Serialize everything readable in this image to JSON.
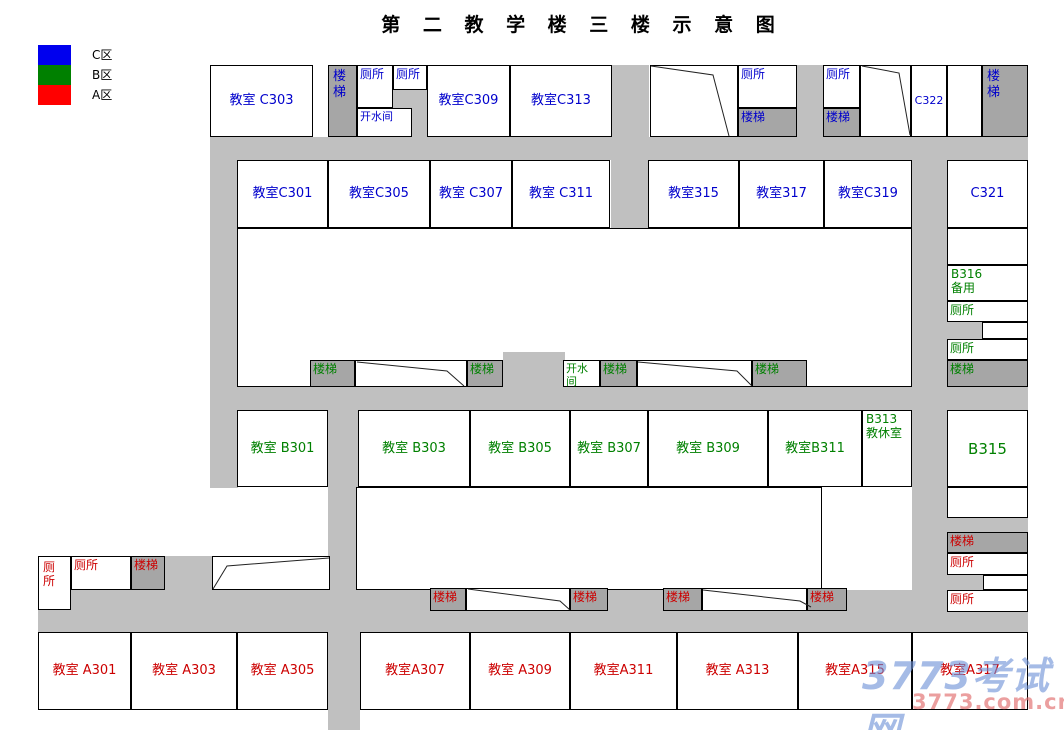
{
  "title": "第 二 教 学 楼 三 楼 示 意 图",
  "legend": [
    {
      "name": "legend-zone-c",
      "label": "C区",
      "color": "#0000ee"
    },
    {
      "name": "legend-zone-b",
      "label": "B区",
      "color": "#008000"
    },
    {
      "name": "legend-zone-a",
      "label": "A区",
      "color": "#ff0000"
    }
  ],
  "palette": {
    "corridor": "#c0c0c0",
    "stair_fill": "#a6a6a6",
    "room_fill": "#ffffff",
    "border": "#000000",
    "zone_c_text": "#0000cc",
    "zone_b_text": "#008000",
    "zone_a_text": "#cc0000",
    "title_text": "#000000"
  },
  "watermark": {
    "line1": "3773考试网",
    "line2": "3773.com.cn",
    "color1": "rgba(110,145,215,0.62)",
    "color2": "rgba(225,110,110,0.66)"
  },
  "corridors": [
    {
      "x": 210,
      "y": 137,
      "w": 818,
      "h": 23
    },
    {
      "x": 210,
      "y": 387,
      "w": 818,
      "h": 23
    },
    {
      "x": 38,
      "y": 590,
      "w": 990,
      "h": 42
    },
    {
      "x": 210,
      "y": 137,
      "w": 28,
      "h": 351
    },
    {
      "x": 611,
      "y": 65,
      "w": 38,
      "h": 163
    },
    {
      "x": 912,
      "y": 137,
      "w": 35,
      "h": 495
    },
    {
      "x": 328,
      "y": 408,
      "w": 30,
      "h": 224
    },
    {
      "x": 328,
      "y": 632,
      "w": 32,
      "h": 98
    },
    {
      "x": 797,
      "y": 65,
      "w": 26,
      "h": 72
    },
    {
      "x": 393,
      "y": 90,
      "w": 19,
      "h": 18
    },
    {
      "x": 412,
      "y": 90,
      "w": 15,
      "h": 47
    },
    {
      "x": 947,
      "y": 322,
      "w": 35,
      "h": 17
    },
    {
      "x": 947,
      "y": 518,
      "w": 81,
      "h": 14
    },
    {
      "x": 947,
      "y": 575,
      "w": 36,
      "h": 15
    },
    {
      "x": 165,
      "y": 556,
      "w": 47,
      "h": 34
    }
  ],
  "rooms": [
    {
      "name": "room-c303",
      "label": "教室 C303",
      "zone": "C",
      "x": 210,
      "y": 65,
      "w": 103,
      "h": 72,
      "kind": "room",
      "style": "c"
    },
    {
      "name": "stair-top-left",
      "label": "楼\n梯",
      "zone": "C",
      "x": 328,
      "y": 65,
      "w": 29,
      "h": 72,
      "kind": "stair",
      "style": "spread"
    },
    {
      "name": "toilet-top-1",
      "label": "厕所",
      "zone": "C",
      "x": 357,
      "y": 65,
      "w": 36,
      "h": 43,
      "kind": "room",
      "style": "tl",
      "fs": 12
    },
    {
      "name": "toilet-top-2",
      "label": "厕所",
      "zone": "C",
      "x": 393,
      "y": 65,
      "w": 34,
      "h": 25,
      "kind": "room",
      "style": "tl",
      "fs": 12
    },
    {
      "name": "boiler-room-top",
      "label": "开水间",
      "zone": "C",
      "x": 357,
      "y": 108,
      "w": 55,
      "h": 29,
      "kind": "room",
      "style": "tl",
      "fs": 11
    },
    {
      "name": "room-c309",
      "label": "教室C309",
      "zone": "C",
      "x": 427,
      "y": 65,
      "w": 83,
      "h": 72,
      "kind": "room",
      "style": "c"
    },
    {
      "name": "room-c313",
      "label": "教室C313",
      "zone": "C",
      "x": 510,
      "y": 65,
      "w": 102,
      "h": 72,
      "kind": "room",
      "style": "c"
    },
    {
      "name": "stairwell-top-1",
      "label": "",
      "zone": "",
      "x": 650,
      "y": 65,
      "w": 88,
      "h": 72,
      "kind": "room",
      "style": "c"
    },
    {
      "name": "toilet-top-3",
      "label": "厕所",
      "zone": "C",
      "x": 738,
      "y": 65,
      "w": 59,
      "h": 43,
      "kind": "room",
      "style": "tl",
      "fs": 12
    },
    {
      "name": "stair-top-1",
      "label": "楼梯",
      "zone": "C",
      "x": 738,
      "y": 108,
      "w": 59,
      "h": 29,
      "kind": "stair",
      "style": "tl",
      "fs": 12
    },
    {
      "name": "toilet-top-4",
      "label": "厕所",
      "zone": "C",
      "x": 823,
      "y": 65,
      "w": 37,
      "h": 43,
      "kind": "room",
      "style": "tl",
      "fs": 12
    },
    {
      "name": "stair-top-2",
      "label": "楼梯",
      "zone": "C",
      "x": 823,
      "y": 108,
      "w": 37,
      "h": 29,
      "kind": "stair",
      "style": "tl",
      "fs": 12
    },
    {
      "name": "stairwell-top-2",
      "label": "",
      "zone": "",
      "x": 860,
      "y": 65,
      "w": 51,
      "h": 72,
      "kind": "room",
      "style": "c"
    },
    {
      "name": "room-c322",
      "label": "C322",
      "zone": "C",
      "x": 911,
      "y": 65,
      "w": 36,
      "h": 72,
      "kind": "room",
      "style": "c",
      "fs": 11
    },
    {
      "name": "room-top-right-blank",
      "label": "",
      "zone": "",
      "x": 947,
      "y": 65,
      "w": 35,
      "h": 72,
      "kind": "room",
      "style": "c"
    },
    {
      "name": "stair-top-right",
      "label": "楼\n梯",
      "zone": "C",
      "x": 982,
      "y": 65,
      "w": 46,
      "h": 72,
      "kind": "stair",
      "style": "spread"
    },
    {
      "name": "room-c301",
      "label": "教室C301",
      "zone": "C",
      "x": 237,
      "y": 160,
      "w": 91,
      "h": 68,
      "kind": "room",
      "style": "c"
    },
    {
      "name": "room-c305",
      "label": "教室C305",
      "zone": "C",
      "x": 328,
      "y": 160,
      "w": 102,
      "h": 68,
      "kind": "room",
      "style": "c"
    },
    {
      "name": "room-c307",
      "label": "教室 C307",
      "zone": "C",
      "x": 430,
      "y": 160,
      "w": 82,
      "h": 68,
      "kind": "room",
      "style": "c"
    },
    {
      "name": "room-c311",
      "label": "教室 C311",
      "zone": "C",
      "x": 512,
      "y": 160,
      "w": 98,
      "h": 68,
      "kind": "room",
      "style": "c"
    },
    {
      "name": "room-315",
      "label": "教室315",
      "zone": "C",
      "x": 648,
      "y": 160,
      "w": 91,
      "h": 68,
      "kind": "room",
      "style": "c"
    },
    {
      "name": "room-317",
      "label": "教室317",
      "zone": "C",
      "x": 739,
      "y": 160,
      "w": 85,
      "h": 68,
      "kind": "room",
      "style": "c"
    },
    {
      "name": "room-c319",
      "label": "教室C319",
      "zone": "C",
      "x": 824,
      "y": 160,
      "w": 88,
      "h": 68,
      "kind": "room",
      "style": "c"
    },
    {
      "name": "room-c321",
      "label": "C321",
      "zone": "C",
      "x": 947,
      "y": 160,
      "w": 81,
      "h": 68,
      "kind": "room",
      "style": "c"
    },
    {
      "name": "courtyard-upper",
      "label": "",
      "zone": "",
      "x": 237,
      "y": 228,
      "w": 675,
      "h": 159,
      "kind": "room",
      "style": "c"
    },
    {
      "name": "corridor-notch-mid",
      "label": "",
      "zone": "",
      "x": 503,
      "y": 352,
      "w": 62,
      "h": 35,
      "kind": "corridor",
      "style": "c"
    },
    {
      "name": "stair-mid-1",
      "label": "楼梯",
      "zone": "B",
      "x": 310,
      "y": 360,
      "w": 45,
      "h": 27,
      "kind": "stair",
      "style": "tl",
      "fs": 12
    },
    {
      "name": "stairwell-mid-1",
      "label": "",
      "zone": "",
      "x": 355,
      "y": 360,
      "w": 112,
      "h": 27,
      "kind": "room",
      "style": "c"
    },
    {
      "name": "stair-mid-2",
      "label": "楼梯",
      "zone": "B",
      "x": 467,
      "y": 360,
      "w": 36,
      "h": 27,
      "kind": "stair",
      "style": "tl",
      "fs": 12
    },
    {
      "name": "boiler-room-mid",
      "label": "开水间",
      "zone": "B",
      "x": 563,
      "y": 360,
      "w": 37,
      "h": 27,
      "kind": "room",
      "style": "tl",
      "fs": 11
    },
    {
      "name": "stair-mid-3",
      "label": "楼梯",
      "zone": "B",
      "x": 600,
      "y": 360,
      "w": 37,
      "h": 27,
      "kind": "stair",
      "style": "tl",
      "fs": 12
    },
    {
      "name": "stairwell-mid-2",
      "label": "",
      "zone": "",
      "x": 637,
      "y": 360,
      "w": 115,
      "h": 27,
      "kind": "room",
      "style": "c"
    },
    {
      "name": "stair-mid-4",
      "label": "楼梯",
      "zone": "B",
      "x": 752,
      "y": 360,
      "w": 55,
      "h": 27,
      "kind": "stair",
      "style": "tl",
      "fs": 12
    },
    {
      "name": "room-b301",
      "label": "教室 B301",
      "zone": "B",
      "x": 237,
      "y": 410,
      "w": 91,
      "h": 77,
      "kind": "room",
      "style": "c"
    },
    {
      "name": "room-b303",
      "label": "教室 B303",
      "zone": "B",
      "x": 358,
      "y": 410,
      "w": 112,
      "h": 77,
      "kind": "room",
      "style": "c"
    },
    {
      "name": "room-b305",
      "label": "教室 B305",
      "zone": "B",
      "x": 470,
      "y": 410,
      "w": 100,
      "h": 77,
      "kind": "room",
      "style": "c"
    },
    {
      "name": "room-b307",
      "label": "教室 B307",
      "zone": "B",
      "x": 570,
      "y": 410,
      "w": 78,
      "h": 77,
      "kind": "room",
      "style": "c"
    },
    {
      "name": "room-b309",
      "label": "教室 B309",
      "zone": "B",
      "x": 648,
      "y": 410,
      "w": 120,
      "h": 77,
      "kind": "room",
      "style": "c"
    },
    {
      "name": "room-b311",
      "label": "教室B311",
      "zone": "B",
      "x": 768,
      "y": 410,
      "w": 94,
      "h": 77,
      "kind": "room",
      "style": "c"
    },
    {
      "name": "room-b313",
      "label": "B313\n教休室",
      "zone": "B",
      "x": 862,
      "y": 410,
      "w": 50,
      "h": 77,
      "kind": "room",
      "style": "two",
      "fs": 12
    },
    {
      "name": "room-b315",
      "label": "B315",
      "zone": "B",
      "x": 947,
      "y": 410,
      "w": 81,
      "h": 77,
      "kind": "room",
      "style": "c",
      "fs": 15
    },
    {
      "name": "room-right-blank-1",
      "label": "",
      "zone": "",
      "x": 947,
      "y": 228,
      "w": 81,
      "h": 37,
      "kind": "room",
      "style": "c"
    },
    {
      "name": "room-b316",
      "label": "B316\n备用",
      "zone": "B",
      "x": 947,
      "y": 265,
      "w": 81,
      "h": 36,
      "kind": "room",
      "style": "two",
      "fs": 12
    },
    {
      "name": "toilet-right-1",
      "label": "厕所",
      "zone": "B",
      "x": 947,
      "y": 301,
      "w": 81,
      "h": 21,
      "kind": "room",
      "style": "tl",
      "fs": 12
    },
    {
      "name": "room-right-offset-1",
      "label": "",
      "zone": "",
      "x": 982,
      "y": 322,
      "w": 46,
      "h": 17,
      "kind": "room",
      "style": "c"
    },
    {
      "name": "toilet-right-2",
      "label": "厕所",
      "zone": "B",
      "x": 947,
      "y": 339,
      "w": 81,
      "h": 21,
      "kind": "room",
      "style": "tl",
      "fs": 12
    },
    {
      "name": "stair-right-1",
      "label": "楼梯",
      "zone": "B",
      "x": 947,
      "y": 360,
      "w": 81,
      "h": 27,
      "kind": "stair",
      "style": "tl",
      "fs": 12
    },
    {
      "name": "room-right-blank-2",
      "label": "",
      "zone": "",
      "x": 947,
      "y": 487,
      "w": 81,
      "h": 31,
      "kind": "room",
      "style": "c"
    },
    {
      "name": "stair-right-2",
      "label": "楼梯",
      "zone": "A",
      "x": 947,
      "y": 532,
      "w": 81,
      "h": 21,
      "kind": "stair",
      "style": "tl",
      "fs": 12
    },
    {
      "name": "toilet-right-3",
      "label": "厕所",
      "zone": "A",
      "x": 947,
      "y": 553,
      "w": 81,
      "h": 22,
      "kind": "room",
      "style": "tl",
      "fs": 12
    },
    {
      "name": "room-right-offset-2",
      "label": "",
      "zone": "",
      "x": 983,
      "y": 575,
      "w": 45,
      "h": 15,
      "kind": "room",
      "style": "c"
    },
    {
      "name": "toilet-right-4",
      "label": "厕所",
      "zone": "A",
      "x": 947,
      "y": 590,
      "w": 81,
      "h": 22,
      "kind": "room",
      "style": "tl",
      "fs": 12
    },
    {
      "name": "toilet-bottom-left-tall",
      "label": "厕\n所",
      "zone": "A",
      "x": 38,
      "y": 556,
      "w": 33,
      "h": 54,
      "kind": "room",
      "style": "spread",
      "fs": 12
    },
    {
      "name": "toilet-bottom-left",
      "label": "厕所",
      "zone": "A",
      "x": 71,
      "y": 556,
      "w": 60,
      "h": 34,
      "kind": "room",
      "style": "tl",
      "fs": 12
    },
    {
      "name": "stair-bottom-left",
      "label": "楼梯",
      "zone": "A",
      "x": 131,
      "y": 556,
      "w": 34,
      "h": 34,
      "kind": "stair",
      "style": "tl",
      "fs": 12
    },
    {
      "name": "stairwell-bottom-left",
      "label": "",
      "zone": "",
      "x": 212,
      "y": 556,
      "w": 118,
      "h": 34,
      "kind": "room",
      "style": "c"
    },
    {
      "name": "courtyard-lower",
      "label": "",
      "zone": "",
      "x": 356,
      "y": 487,
      "w": 466,
      "h": 103,
      "kind": "room",
      "style": "c"
    },
    {
      "name": "stair-bottom-1",
      "label": "楼梯",
      "zone": "A",
      "x": 430,
      "y": 588,
      "w": 36,
      "h": 23,
      "kind": "stair",
      "style": "tl",
      "fs": 12
    },
    {
      "name": "stairwell-bottom-1",
      "label": "",
      "zone": "",
      "x": 466,
      "y": 588,
      "w": 104,
      "h": 23,
      "kind": "room",
      "style": "c"
    },
    {
      "name": "stair-bottom-2",
      "label": "楼梯",
      "zone": "A",
      "x": 570,
      "y": 588,
      "w": 38,
      "h": 23,
      "kind": "stair",
      "style": "tl",
      "fs": 12
    },
    {
      "name": "stair-bottom-3",
      "label": "楼梯",
      "zone": "A",
      "x": 663,
      "y": 588,
      "w": 39,
      "h": 23,
      "kind": "stair",
      "style": "tl",
      "fs": 12
    },
    {
      "name": "stairwell-bottom-2",
      "label": "",
      "zone": "",
      "x": 702,
      "y": 588,
      "w": 105,
      "h": 23,
      "kind": "room",
      "style": "c"
    },
    {
      "name": "stair-bottom-4",
      "label": "楼梯",
      "zone": "A",
      "x": 807,
      "y": 588,
      "w": 40,
      "h": 23,
      "kind": "stair",
      "style": "tl",
      "fs": 12
    },
    {
      "name": "room-a301",
      "label": "教室 A301",
      "zone": "A",
      "x": 38,
      "y": 632,
      "w": 93,
      "h": 78,
      "kind": "room",
      "style": "c"
    },
    {
      "name": "room-a303",
      "label": "教室 A303",
      "zone": "A",
      "x": 131,
      "y": 632,
      "w": 106,
      "h": 78,
      "kind": "room",
      "style": "c"
    },
    {
      "name": "room-a305",
      "label": "教室 A305",
      "zone": "A",
      "x": 237,
      "y": 632,
      "w": 91,
      "h": 78,
      "kind": "room",
      "style": "c"
    },
    {
      "name": "room-a307",
      "label": "教室A307",
      "zone": "A",
      "x": 360,
      "y": 632,
      "w": 110,
      "h": 78,
      "kind": "room",
      "style": "c"
    },
    {
      "name": "room-a309",
      "label": "教室 A309",
      "zone": "A",
      "x": 470,
      "y": 632,
      "w": 100,
      "h": 78,
      "kind": "room",
      "style": "c"
    },
    {
      "name": "room-a311",
      "label": "教室A311",
      "zone": "A",
      "x": 570,
      "y": 632,
      "w": 107,
      "h": 78,
      "kind": "room",
      "style": "c"
    },
    {
      "name": "room-a313",
      "label": "教室 A313",
      "zone": "A",
      "x": 677,
      "y": 632,
      "w": 121,
      "h": 78,
      "kind": "room",
      "style": "c"
    },
    {
      "name": "room-a315",
      "label": "教室A315",
      "zone": "A",
      "x": 798,
      "y": 632,
      "w": 114,
      "h": 78,
      "kind": "room",
      "style": "c"
    },
    {
      "name": "room-a317",
      "label": "教室A317",
      "zone": "A",
      "x": 912,
      "y": 632,
      "w": 116,
      "h": 78,
      "kind": "room",
      "style": "c"
    }
  ],
  "stair_lines": [
    [
      [
        651,
        66
      ],
      [
        713,
        75
      ],
      [
        729,
        136
      ]
    ],
    [
      [
        862,
        66
      ],
      [
        899,
        73
      ],
      [
        910,
        135
      ]
    ],
    [
      [
        357,
        362
      ],
      [
        447,
        371
      ],
      [
        464,
        386
      ]
    ],
    [
      [
        638,
        362
      ],
      [
        737,
        371
      ],
      [
        752,
        386
      ]
    ],
    [
      [
        213,
        589
      ],
      [
        227,
        566
      ],
      [
        329,
        558
      ]
    ],
    [
      [
        468,
        589
      ],
      [
        560,
        601
      ],
      [
        570,
        610
      ]
    ],
    [
      [
        703,
        590
      ],
      [
        800,
        601
      ],
      [
        811,
        607
      ]
    ]
  ]
}
